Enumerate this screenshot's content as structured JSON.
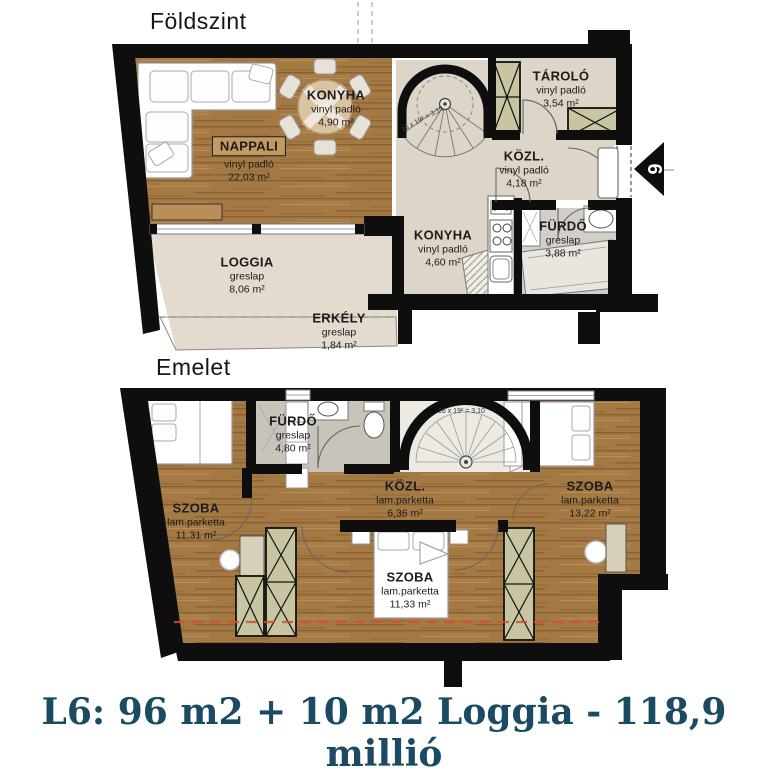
{
  "title": {
    "text": "L6: 96 m2 + 10 m2 Loggia - 118,9 millió"
  },
  "floors": [
    {
      "label": "Földszint",
      "stair_note": "16 x 19² = 3,10",
      "rooms": [
        {
          "name": "NAPPALI",
          "floor_type": "vinyl padló",
          "area": "22,03 m²"
        },
        {
          "name": "KONYHA",
          "floor_type": "vinyl padló",
          "area": "4,90 m²"
        },
        {
          "name": "TÁROLÓ",
          "floor_type": "vinyl padló",
          "area": "3,54 m²"
        },
        {
          "name": "KÖZL.",
          "floor_type": "vinyl padló",
          "area": "4,18 m²"
        },
        {
          "name": "KONYHA",
          "floor_type": "vinyl padló",
          "area": "4,60 m²"
        },
        {
          "name": "FÜRDŐ",
          "floor_type": "greslap",
          "area": "3,88 m²"
        },
        {
          "name": "LOGGIA",
          "floor_type": "greslap",
          "area": "8,06 m²"
        },
        {
          "name": "ERKÉLY",
          "floor_type": "greslap",
          "area": "1,84 m²"
        }
      ]
    },
    {
      "label": "Emelet",
      "stair_note": "16 x 19² = 3,10",
      "rooms": [
        {
          "name": "SZOBA",
          "floor_type": "lam.parketta",
          "area": "11,31 m²"
        },
        {
          "name": "FÜRDŐ",
          "floor_type": "greslap",
          "area": "4,80 m²"
        },
        {
          "name": "KÖZL.",
          "floor_type": "lam.parketta",
          "area": "6,36 m²"
        },
        {
          "name": "SZOBA",
          "floor_type": "lam.parketta",
          "area": "13,22 m²"
        },
        {
          "name": "SZOBA",
          "floor_type": "lam.parketta",
          "area": "11,33 m²"
        }
      ]
    }
  ],
  "entry_marker": {
    "number": "6"
  },
  "colors": {
    "wall": "#0e0e0e",
    "wood_floor": "#a47943",
    "tile_beige": "#dcd5c8",
    "tile_grey_ground": "#d3cfc8",
    "tile_grey_upper": "#c8c4bc",
    "wardrobe": "#c8c5a2",
    "section_dash_red": "#d4502a",
    "title_blue": "#1b4a63",
    "accent_yellow": "#e2e040"
  }
}
